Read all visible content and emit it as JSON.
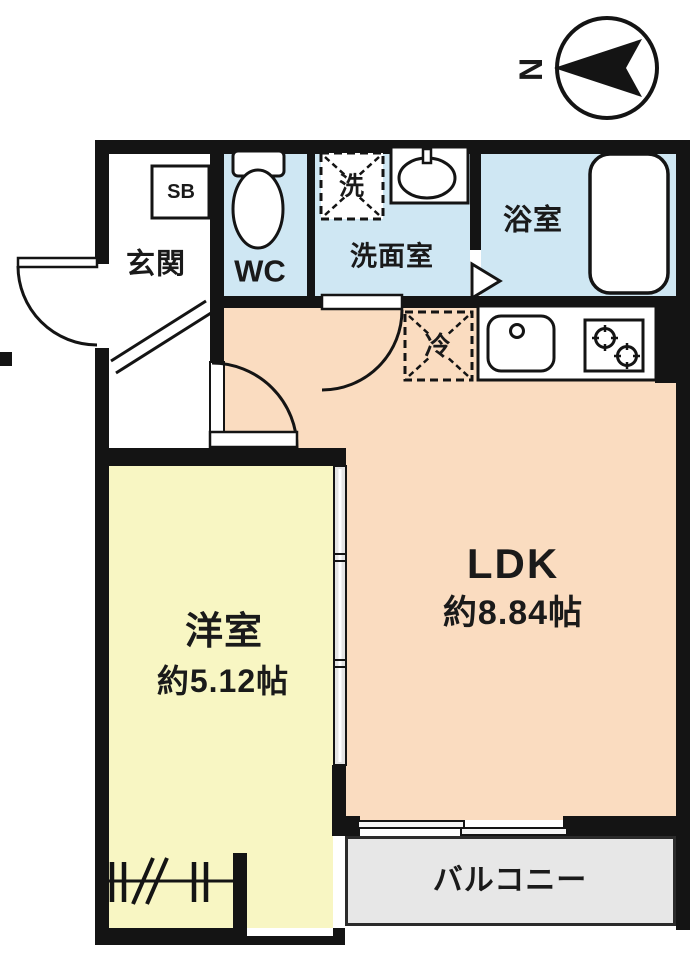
{
  "title": "apartment-floor-plan",
  "compass": {
    "label": "N"
  },
  "rooms": {
    "genkan": {
      "name": "玄関"
    },
    "wc": {
      "name": "WC"
    },
    "senmen": {
      "name": "洗面室"
    },
    "bath": {
      "name": "浴室"
    },
    "ldk": {
      "name": "LDK",
      "size": "約8.84帖"
    },
    "bedroom": {
      "name": "洋室",
      "size": "約5.12帖"
    },
    "balcony": {
      "name": "バルコニー"
    }
  },
  "fixtures": {
    "shoe_box_label": "SB",
    "washer_pan_label": "洗",
    "fridge_pan_label": "冷"
  },
  "icons": [
    "compass-icon",
    "toilet-icon",
    "washbasin-icon",
    "bathtub-icon",
    "kitchen-sink-icon",
    "stove-burner-icon",
    "door-swing-icon",
    "sliding-door-icon",
    "sliding-window-icon",
    "door-direction-arrow-icon",
    "washer-pan-icon",
    "fridge-pan-icon",
    "window-ticks-icon"
  ],
  "colors": {
    "wall": "#141414",
    "wet_room_floor": "#cfe7f3",
    "ldk_floor": "#fadcc0",
    "bedroom_floor": "#f8f6c3",
    "balcony_floor": "#e7e7e7",
    "fixture_fill": "#ffffff"
  }
}
